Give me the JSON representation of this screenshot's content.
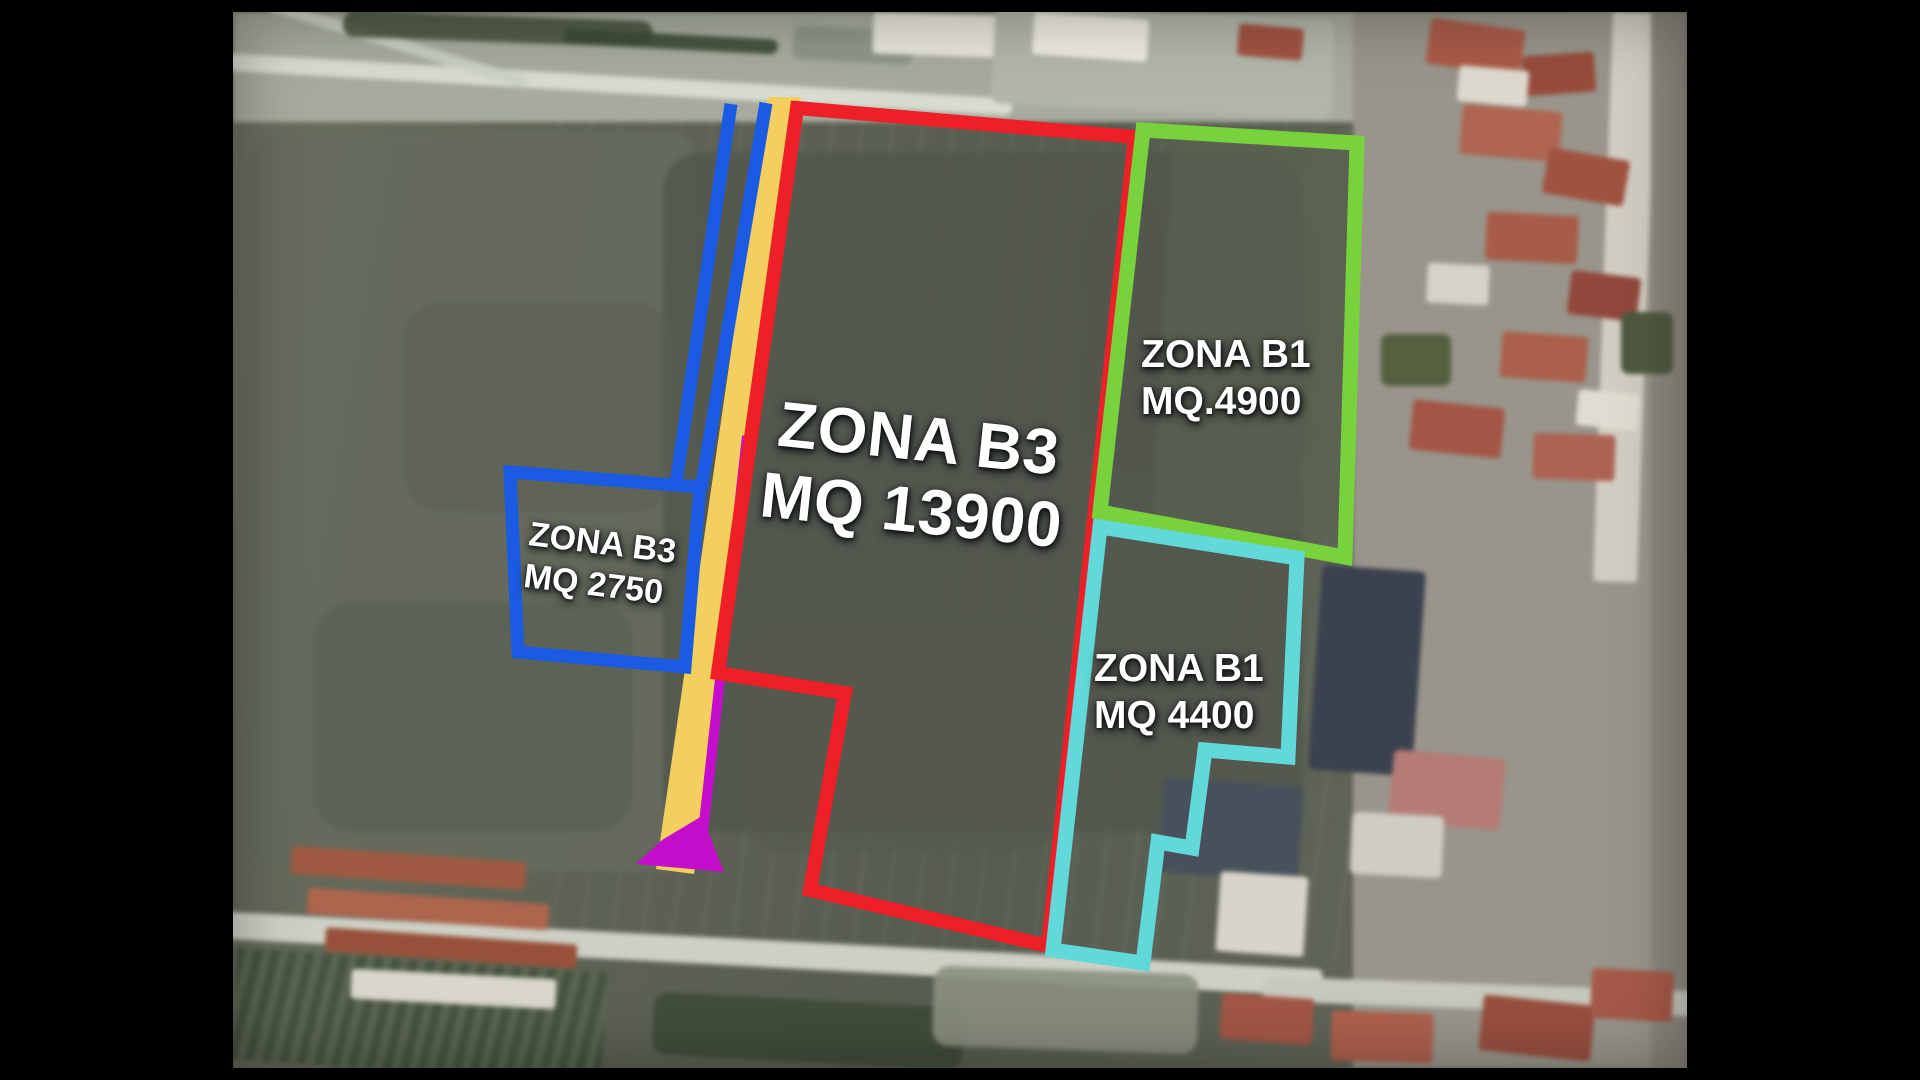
{
  "map": {
    "zones": [
      {
        "name": "ZONA B3",
        "area": "MQ 13900",
        "color": "#ee2027"
      },
      {
        "name": "ZONA B1",
        "area": "MQ.4900",
        "color": "#78d23e"
      },
      {
        "name": "ZONA B1",
        "area": "MQ 4400",
        "color": "#62d8da"
      },
      {
        "name": "ZONA B3",
        "area": "MQ 2750",
        "color": "#1b5ae2"
      }
    ],
    "road_strip_color": "#f3cf60",
    "access_marker_color": "#c40ecc",
    "frame_color": "#000000",
    "label_text_color": "#ffffff"
  }
}
